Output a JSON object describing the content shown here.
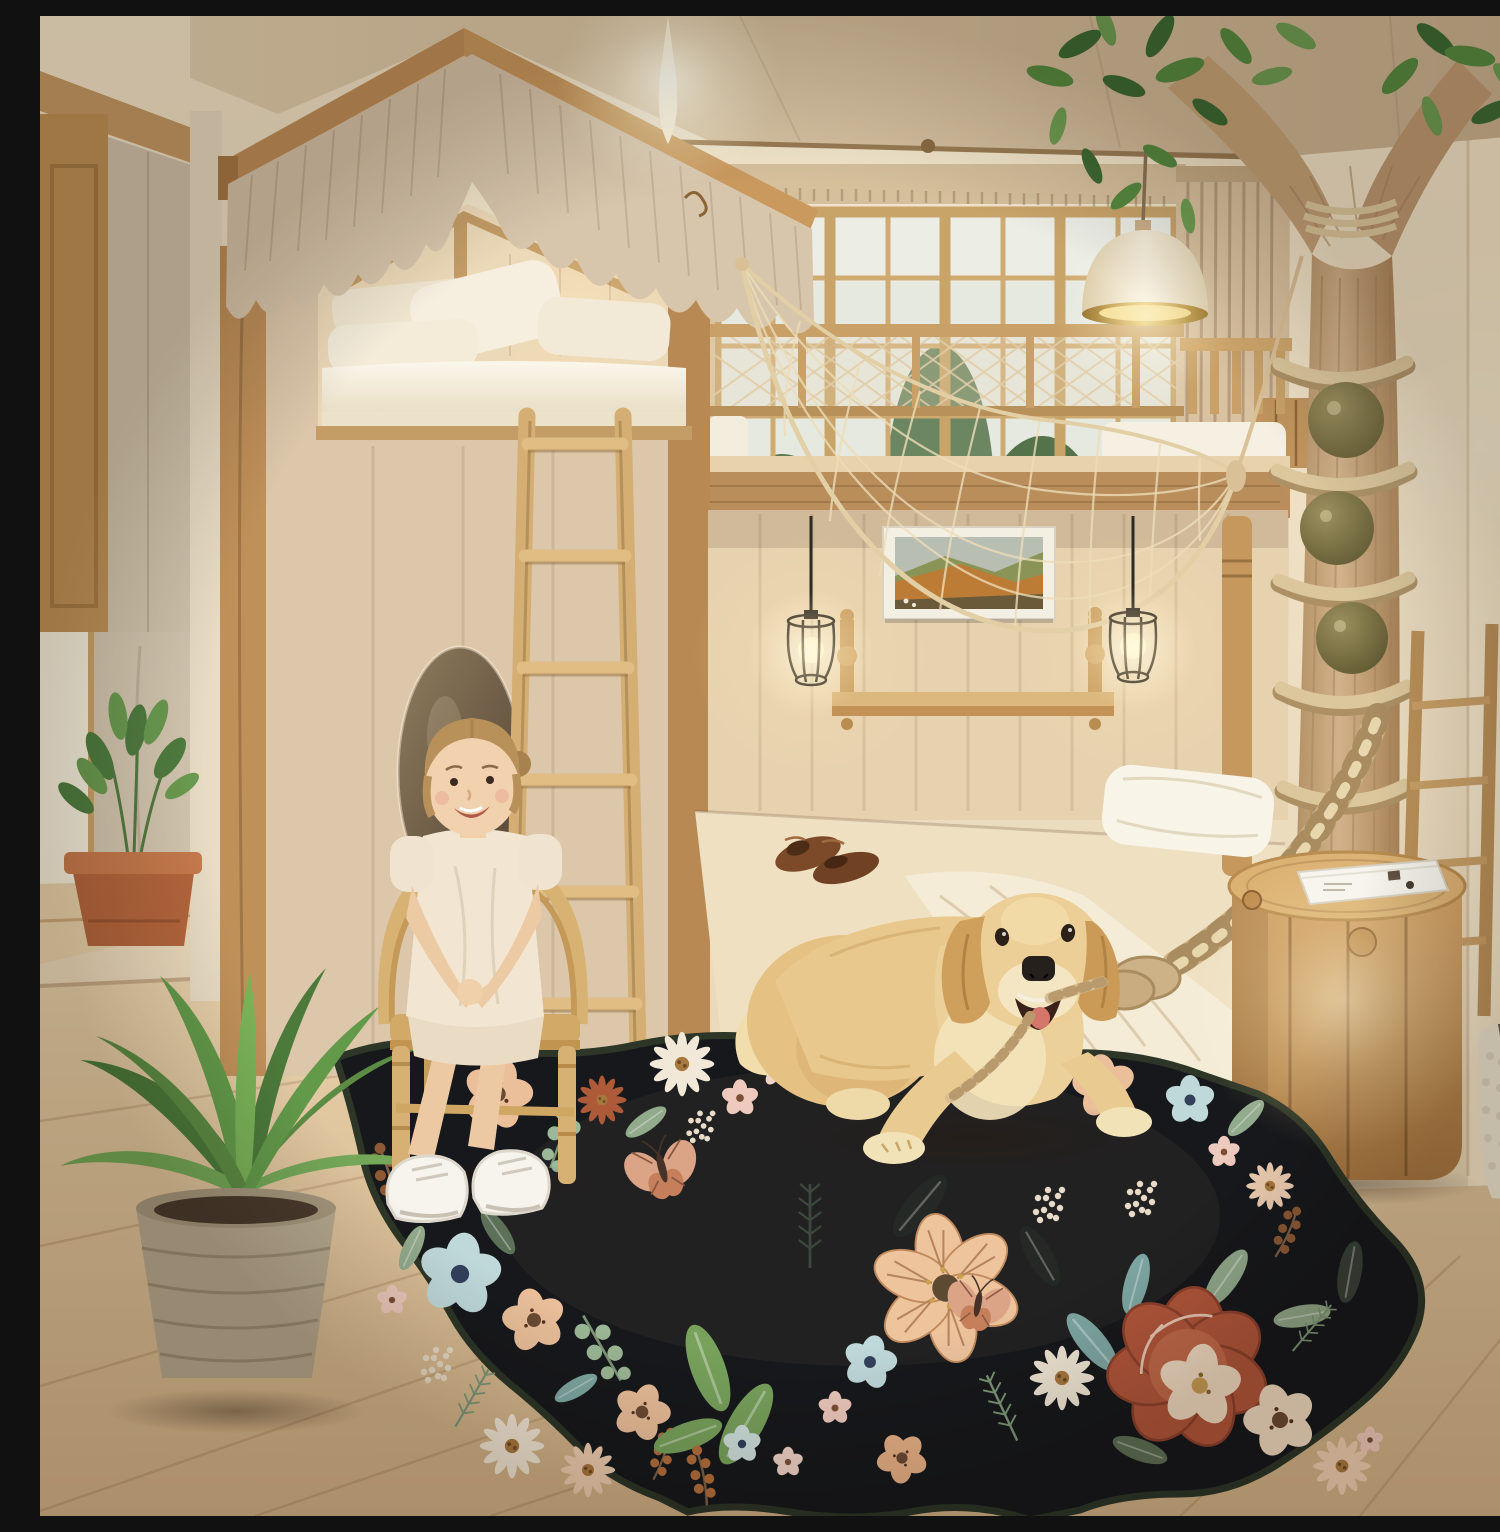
{
  "meta": {
    "kind": "product-photo",
    "alt": "Treehouse-themed children's bedroom: house-frame loft bed with ruffled canopy, paned windows with a forest view, rope net canopy, decorative indoor tree with rope-wrapped trunk, lower bed with beige bedding, a smiling girl on a rattan chair, a golden retriever holding a rope leash, and a black scallop-edged floral area rug."
  },
  "labels": {
    "rug": "black floral scalloped area rug",
    "dog": "golden retriever holding rope leash",
    "girl": "child sitting on rattan chair",
    "chair": "rattan kids chair",
    "house_bed": "house-frame loft bed with ruffled valance",
    "lower_bed": "lower bed with beige bedding and white sheet",
    "tree": "indoor decorative tree with rope rings and olive balls",
    "net": "hanging rope net canopy",
    "nightstand": "barrel-style wooden nightstand",
    "book": "white book on nightstand",
    "ladder": "wooden bunk ladder",
    "fern": "potted fern plant",
    "sill_plant": "terracotta potted plant on window sill",
    "windows": "grid-paned windows with trees outside",
    "curtain": "beige pinch-pleat curtain",
    "pendant_lamp": "cream dome pendant lamp with gold interior",
    "cage_lamps": "black caged pendant bulbs",
    "ceiling_light": "glowing ceiling light",
    "picture": "framed autumn landscape picture",
    "shelf": "wooden wall shelf with turned posts",
    "mirror": "round wall mirror",
    "shoes": "brown leather loafers on bed",
    "vase": "white woven vase",
    "mesh_railing": "loft railing with net infill",
    "rope": "thick braided climbing rope"
  },
  "palette": {
    "wall": "#ecdcc2",
    "ceiling": "#d8c3a3",
    "wood_trim": "#c4965f",
    "panel": "#e0cbaa",
    "floor": "#dcc29c",
    "valance": "#d8c6ac",
    "mattress": "#f6f1e2",
    "rug_black": "#17181b",
    "rug_binding": "#2c3526",
    "peach_flower": "#eabf9a",
    "terracotta_flower": "#b2573b",
    "blue_flower": "#bfd8da",
    "sage_leaf": "#93ab8d",
    "butterfly": "#dba487",
    "dog_golden": "#e7c588",
    "leaf_green": "#578a40",
    "rope": "#cdb288",
    "lamp_gold": "#d9b257",
    "terracotta_pot": "#b4663c"
  }
}
